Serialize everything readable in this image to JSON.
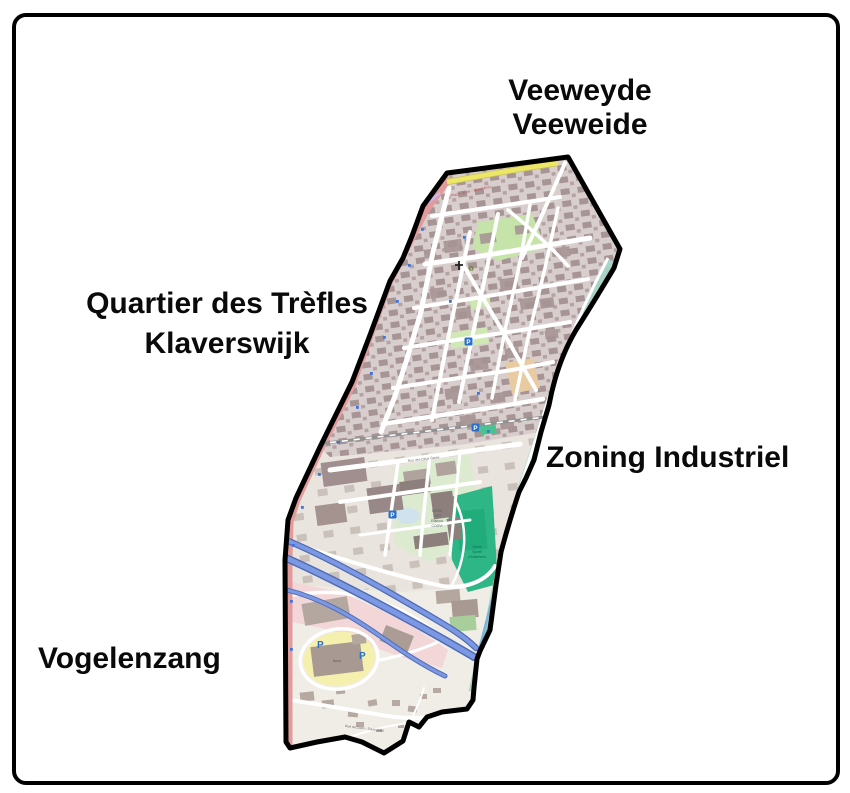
{
  "figure": {
    "type": "district-map",
    "background": "#ffffff"
  },
  "districts": {
    "top": {
      "line1": "Veeweyde",
      "line2": "Veeweide"
    },
    "left": {
      "line1": "Quartier des Trèfles",
      "line2": "Klaverswijk"
    },
    "right": {
      "line1": "Zoning Industriel"
    },
    "bottom_left": {
      "line1": "Vogelenzang"
    }
  },
  "map_labels": {
    "place_bizet": "Place Bizet - Bizetplein",
    "quai": "Quai de Veeweyde",
    "rue_deux_gares": "Rue des Deux Gares",
    "rue_zuen": "Rue de Zuen - Zuunstraat",
    "campus_l1": "CERIA",
    "campus_l2": "CVO",
    "campus_l3": "Elishout",
    "campus_l4": "COOVI",
    "sport_l1": "Centre",
    "sport_l2": "Sportif",
    "sport_l3": "d'Anderlecht",
    "store": "Ikea",
    "parking_letter": "P",
    "recycling_glyph": "♻"
  },
  "palette": {
    "frame_border": "#000000",
    "page_bg": "#ffffff",
    "label_text": "#0a0a0a",
    "boundary": "#000000",
    "map_base": "#f2efe9",
    "upper_block": "#d9cece",
    "upper_building": "#a79494",
    "mid_base": "#e9e4de",
    "mid_building": "#b2a49e",
    "lower_base": "#f0ece6",
    "street": "#ffffff",
    "road_red": "#e29a9a",
    "road_yellow": "#ece766",
    "park_green": "#c6e3a9",
    "campus_green": "#dcebcf",
    "sport_teal": "#2eb686",
    "canal_teal": "#a5d5c8",
    "water_blue": "#7bb3d9",
    "pink_zone": "#f3d7d8",
    "parking_yellow": "#f6f0ae",
    "motorway_blue": "#7d98e3",
    "motorway_casing": "#4f6cb8",
    "railway_gray": "#919191",
    "parking_blue": "#2a6fc9",
    "tan_block": "#e9cba2",
    "street_label": "#6b6b6b",
    "road_label_red": "#b05a5a"
  }
}
